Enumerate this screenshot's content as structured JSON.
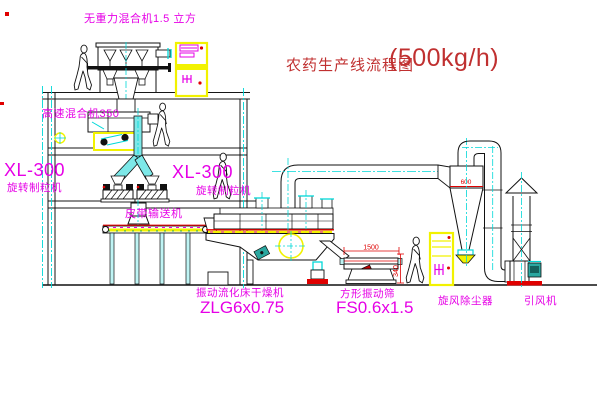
{
  "title": {
    "text": "农药生产线流程图",
    "capacity": "(500kg/h)"
  },
  "labels": {
    "gravity_mixer": "无重力混合机1.5 立方",
    "high_speed_mixer": "高速混合机350",
    "granulator_left_model": "XL-300",
    "granulator_left_name": "旋转制粒机",
    "granulator_right_model": "XL-300",
    "granulator_right_name": "旋转制粒机",
    "belt_conveyor": "皮带输送机",
    "fluid_bed_dryer_name": "振动流化床干燥机",
    "fluid_bed_dryer_model": "ZLG6x0.75",
    "vibrating_screen_name": "方形振动筛",
    "vibrating_screen_model": "FS0.6x1.5",
    "cyclone_name": "旋风除尘器",
    "fan_name": "引风机"
  },
  "dimensions": {
    "cyclone_inlet_width": "600",
    "screen_length": "1500",
    "screen_height": "340"
  },
  "colors": {
    "label_magenta": "#e600e6",
    "title_red": "#c03030",
    "dimension_red": "#dd0000",
    "centerline_cyan": "#00d8d8",
    "cabinet_yellow": "#f2f200",
    "duct_cyan": "#7de8e8",
    "motor_teal": "#2aa7a0",
    "base_red": "#e00000"
  }
}
